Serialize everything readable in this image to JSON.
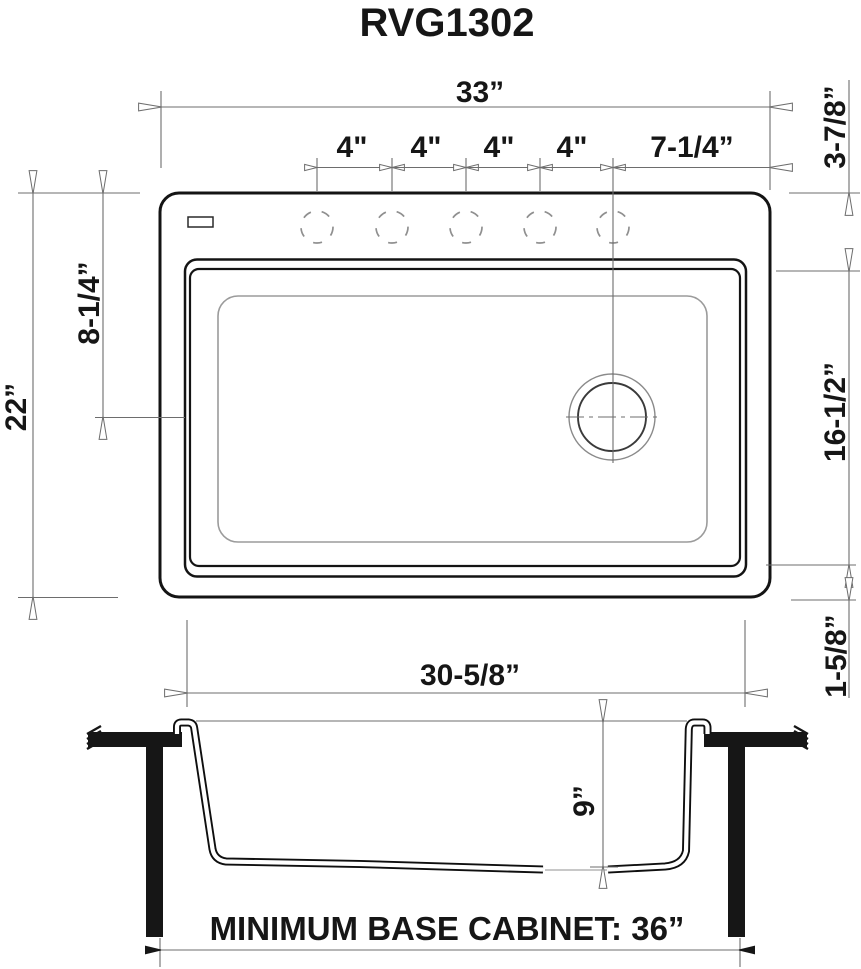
{
  "title": "RVG1302",
  "top_view": {
    "overall_width": "33”",
    "hole_spacings": [
      "4\"",
      "4\"",
      "4\"",
      "4\""
    ],
    "right_hole_offset": "7-1/4”",
    "back_deck_depth": "3-7/8”",
    "overall_front_back": "22”",
    "drain_center_from_back": "8-1/4”",
    "bowl_front_back": "16-1/2”",
    "front_rim_depth": "1-5/8”",
    "bowl_width": "30-5/8”"
  },
  "section_view": {
    "bowl_depth": "9”",
    "cabinet_note": "MINIMUM BASE CABINET: 36”"
  }
}
